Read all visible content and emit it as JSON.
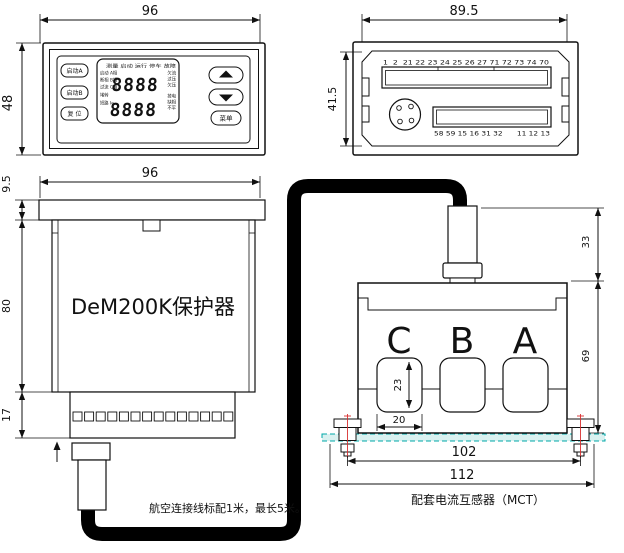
{
  "front_view": {
    "dim_width": "96",
    "dim_height": "48",
    "btn_start_a": "启动A",
    "btn_start_b": "启动B",
    "btn_reset": "复 位",
    "btn_menu": "菜单",
    "lcd_status_row": "测量 启动 运行 停车 故障",
    "lcd_left_labels": [
      "启动 A相",
      "断相 B相",
      "过流 C相",
      "堵转",
      "短路 Ie"
    ],
    "lcd_right_labels": [
      "欠流",
      "过压",
      "欠压",
      "掉电",
      "缺相",
      "不平"
    ],
    "display_row1": "8888",
    "display_row2": "8888"
  },
  "rear_view": {
    "dim_width": "89.5",
    "dim_height": "41.5",
    "top_terminal_numbers": "1  2  21 22 23 24 25 26 27 71 72 73 74 70",
    "bottom_terminal_numbers": "58 59 15 16 31 32      11 12 13"
  },
  "side_view": {
    "dim_width": "96",
    "dim_flange_height": "9.5",
    "dim_body_height": "80",
    "dim_terminal_height": "17",
    "device_label": "DeM200K保护器"
  },
  "ct_view": {
    "dim_stem_height": "33",
    "dim_body_height": "69",
    "dim_window_height": "23",
    "dim_window_width": "20",
    "dim_bolt_span": "102",
    "dim_overall_width": "112",
    "phase_labels": [
      "C",
      "B",
      "A"
    ],
    "caption": "配套电流互感器（MCT）"
  },
  "notes": {
    "cable_note": "航空连接线标配1米，最长5米。"
  },
  "colors": {
    "line": "#111111",
    "cable": "#000000",
    "plate_fill": "#d9f1f0",
    "plate_stroke": "#00a8a8",
    "center_line_red": "#d83030"
  }
}
